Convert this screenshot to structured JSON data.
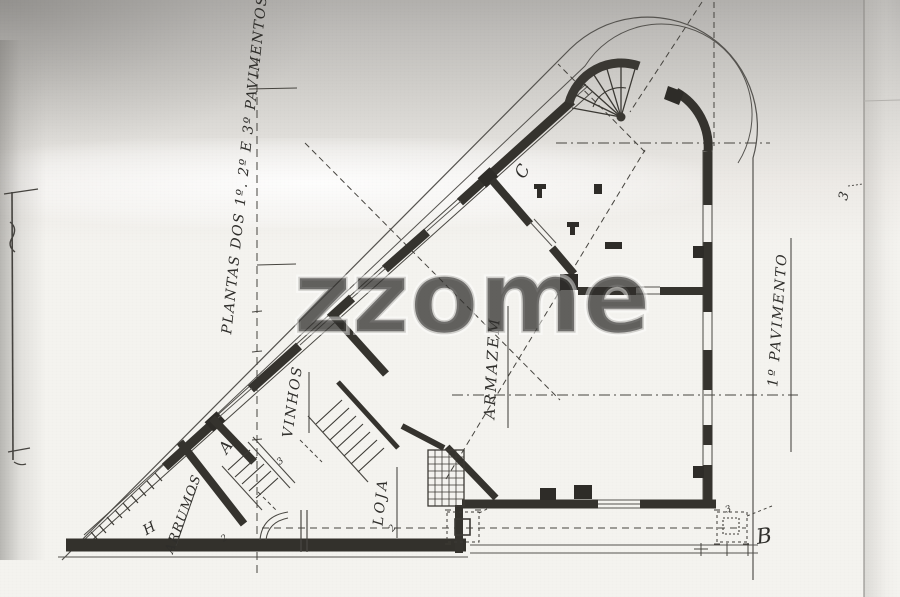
{
  "plan": {
    "title": "PLANTAS DOS 1º. 2º E 3º PAVIMENTOS",
    "floor_label": "1º PAVIMENTO",
    "rooms": {
      "armazem": "ARMAZEM",
      "vinhos": "VINHOS",
      "loja": "LOJA",
      "arrumos": "ARRUMOS"
    },
    "door_letters": {
      "a": "A",
      "b": "B",
      "c": "C",
      "h": "H"
    },
    "marks": {
      "two_a": "2",
      "two_b": "2",
      "three_a": "3",
      "three_b": "3",
      "margin_three": "3"
    }
  },
  "watermark": {
    "text": "zzome"
  },
  "colors": {
    "ink": "#2f2e2b",
    "wall": "#3a3833",
    "paper": "#f4f3ef",
    "scan_shadow": "#aaa8a5",
    "watermark": "#cfcecb"
  }
}
